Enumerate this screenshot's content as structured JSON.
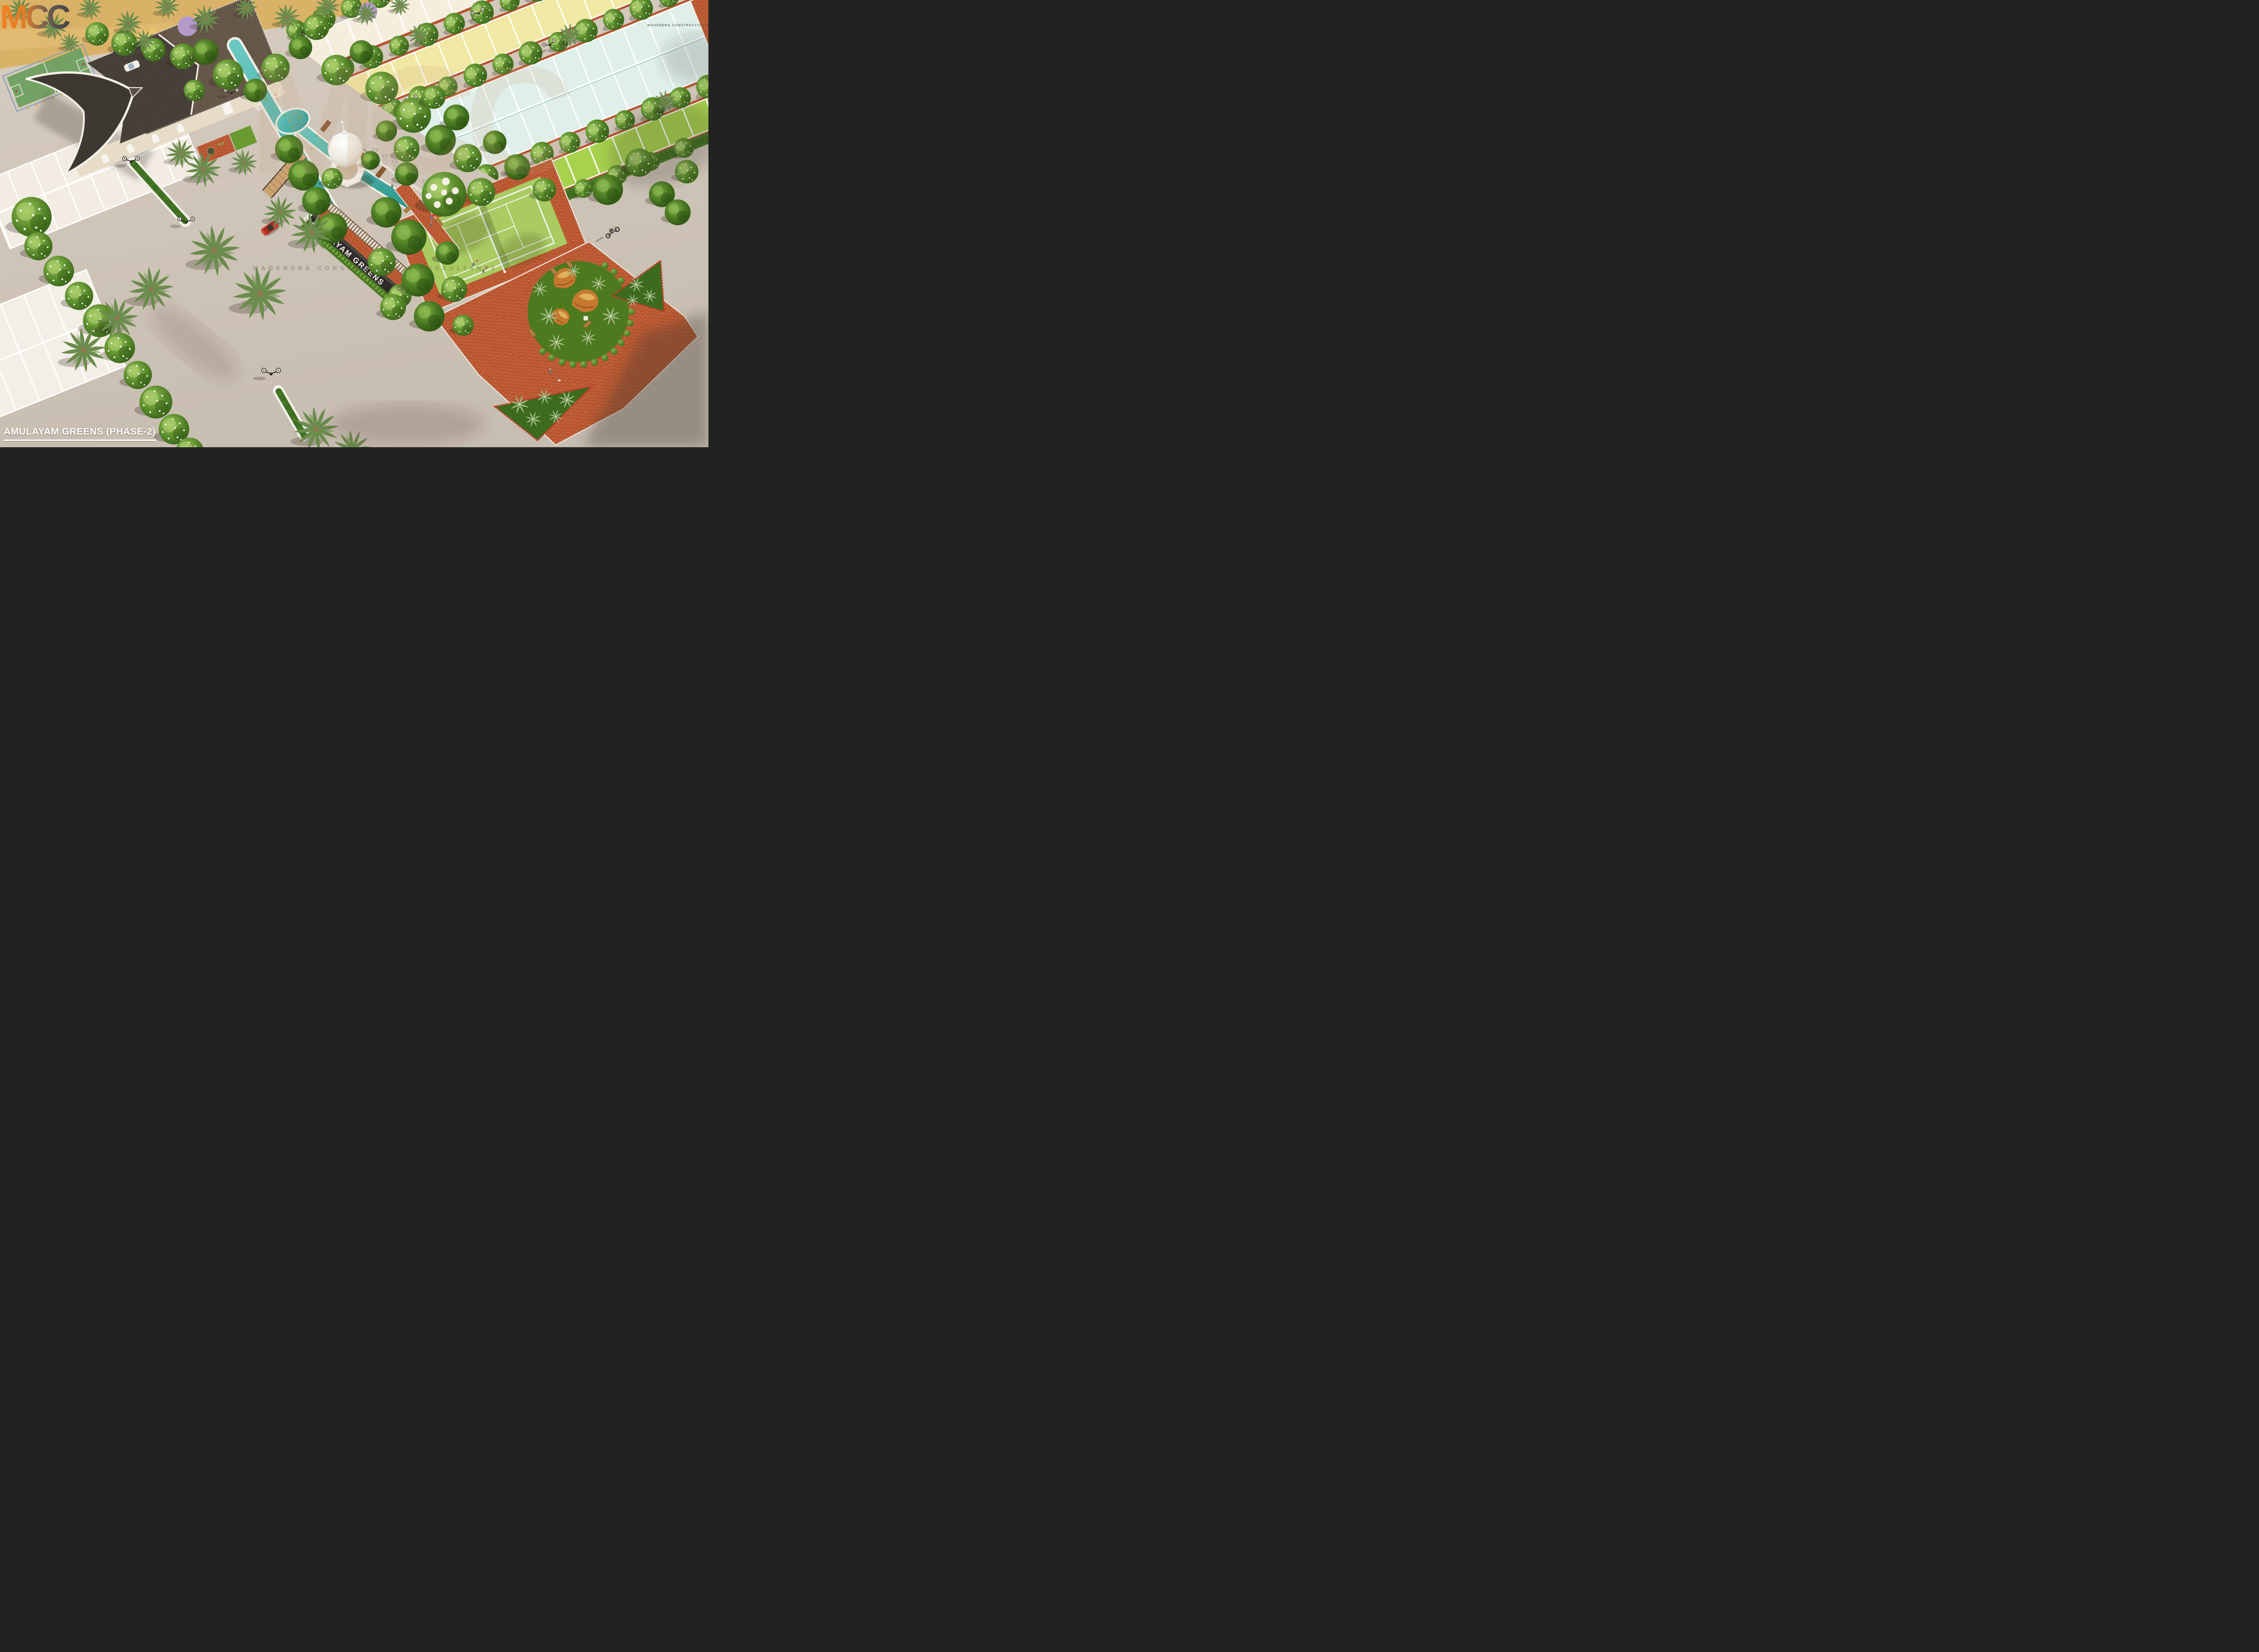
{
  "title_overlay": {
    "text": "AMULAYAM GREENS (PHASE-2)"
  },
  "branding": {
    "logo_text": "MCC",
    "logo_subtext": "MAGENDRA CONSTRUCTION & CONSULTANTS",
    "logo_gradient": [
      "#f5821f",
      "#b06f3f",
      "#4a4746"
    ]
  },
  "watermark": {
    "text": "MCC",
    "subtext": "MAGENDRA CONSTRUCTION & CONSULTANTS"
  },
  "signage": {
    "entrance_wall_text": "AMULAYAM GREENS"
  },
  "scene": {
    "type": "aerial-3d-architectural-render",
    "setting": "gated plotted township with central amenity zone",
    "amenities": [
      "clubhouse with curved dark roof",
      "koi pond with white dome gazebo",
      "wooden foot bridge",
      "pergola trellis panels",
      "sculptural concrete pillars",
      "lawn tennis court",
      "rock garden with topiary crescent",
      "agave flower beds",
      "basketball court",
      "kids playground",
      "tree lined avenues",
      "street lamps",
      "entrance signage wall"
    ],
    "objects": [
      "red sedan car",
      "white sedan car",
      "cyclist with backpack",
      "man walking dog",
      "kid holding balloons",
      "people on bridge",
      "swan in pond"
    ],
    "palette": {
      "road": "#cdc2b6",
      "sand": "#d9b267",
      "pool_water": "#3fa8a1",
      "roof_dark": "#453e38",
      "roof_light": "#6b5c4d",
      "brick_paving": "#c2613a",
      "lawn_dark": "#4e7c1e",
      "tree_green": "#5d8f2d",
      "white_trim": "#f4f1ea"
    },
    "plot_rows": {
      "cream": "#f5eedd",
      "yellow": "#f0e8a4",
      "mint_blue": "#e0efe9",
      "green": "#a8d24e",
      "white": "#f2ece3"
    }
  }
}
